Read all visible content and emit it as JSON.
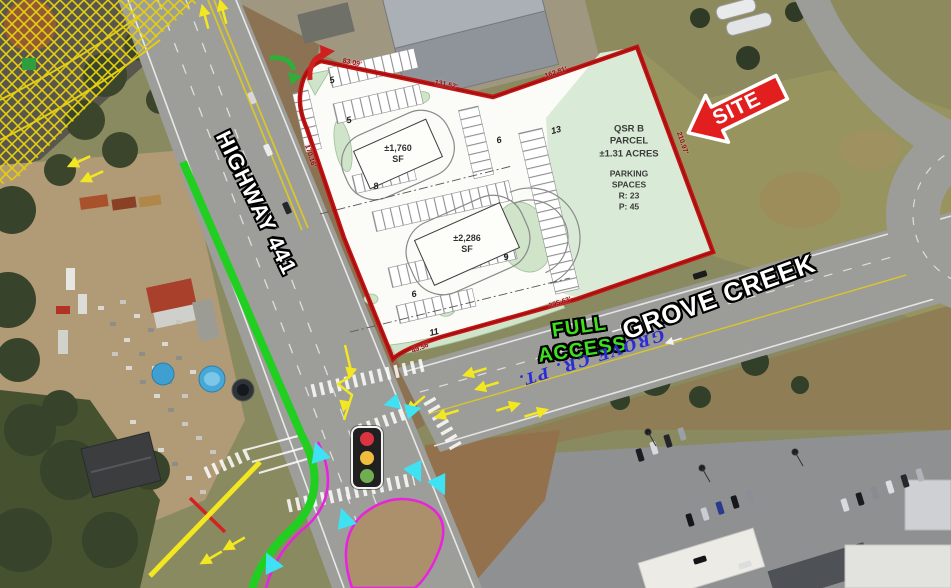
{
  "canvas": {
    "width": 951,
    "height": 588
  },
  "labels": {
    "site": "SITE",
    "highway": "HIGHWAY 441",
    "grove_creek": "GROVE CREEK",
    "full_access_line1": "FULL",
    "full_access_line2": "ACCESS",
    "grove_cr_pt": "GROVE CR. PT."
  },
  "parcel": {
    "name_line1": "QSR B",
    "name_line2": "PARCEL",
    "acreage": "±1.31 ACRES",
    "parking_title_line1": "PARKING",
    "parking_title_line2": "SPACES",
    "parking_r": "R:  23",
    "parking_p": "P:  45",
    "buildings": [
      {
        "area": "±1,760",
        "unit": "SF"
      },
      {
        "area": "±2,286",
        "unit": "SF"
      }
    ],
    "stall_counts": [
      "5",
      "5",
      "8",
      "6",
      "13",
      "6",
      "9",
      "11"
    ],
    "boundary_dimensions": [
      "83.09'",
      "131.52'",
      "162.81'",
      "210.97'",
      "295.63'",
      "49.56'",
      "170.16'"
    ]
  },
  "traffic_light_colors": {
    "red": "#d93440",
    "yellow": "#f0bd3e",
    "green": "#6faf52"
  },
  "map_colors": {
    "boundary_red": "#c41414",
    "site_arrow_red": "#e31e1e",
    "full_access_green": "#3fdf1d",
    "grove_cr_pt_blue": "#2b2bd8",
    "median_green": "#21cf21",
    "curb_magenta": "#e822de",
    "crosswalk_cyan": "#3fe2f2",
    "lane_yellow": "#f3e722",
    "parcel_green": "#d9ead6"
  }
}
